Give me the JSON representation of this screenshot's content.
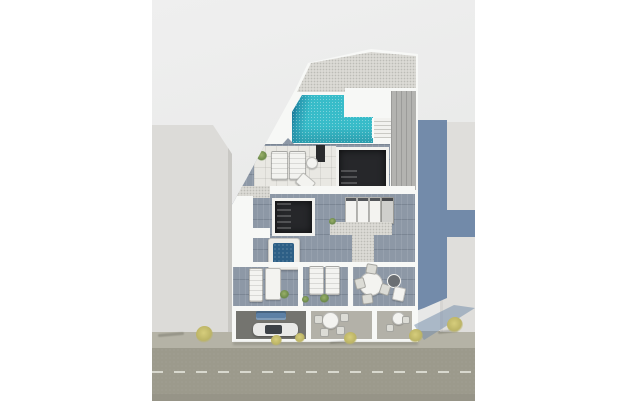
{
  "meta": {
    "description": "Top-down 3D architectural render of a modern apartment building with rooftop pool, wood-deck terraces, hot tub, ground-floor patios and a street with dashed lane markings. No text is visible in the image.",
    "visible_text": []
  },
  "palette": {
    "page_bg": "#ffffff",
    "scene_bg_top": "#efefef",
    "scene_bg": "#e7e8e7",
    "neighbor": "#dcdbd8",
    "neighbor_edge": "#c9c8c4",
    "neighbor_right": "#dfdedb",
    "shadow_blue": "#6e87a7",
    "wall_white": "#f7f8f6",
    "gravel": "#dbdad5",
    "pool_water": "#38bcc9",
    "pool_deep": "#1d7d9c",
    "deck_wood": "#8d98a6",
    "deck_light": "#e9e8e3",
    "side_deck": "#b3b3b0",
    "stair_dark": "#26272a",
    "hot_tub_water": "#2d5f86",
    "sofa_blue": "#5d80a5",
    "pavement_dark": "#74746f",
    "terrace_floor": "#b3b1a8",
    "sidewalk": "#b5b3a6",
    "street": "#9c9a8c",
    "street_edge": "#949285",
    "lane_dash": "#e3e3da",
    "furniture_white": "#f3f3f0",
    "tree_yellow": "#bcb465",
    "plant_green": "#6c8a4a",
    "car_body": "#e9e9e7",
    "glass_dark": "#3c4146"
  },
  "scene": {
    "objects": [
      {
        "name": "rooftop-pool",
        "count": 1
      },
      {
        "name": "hot-tub",
        "count": 1
      },
      {
        "name": "stairwell-opening",
        "count": 2
      },
      {
        "name": "sun-lounger",
        "count": 6
      },
      {
        "name": "round-table",
        "count": 5
      },
      {
        "name": "chair",
        "count": 8
      },
      {
        "name": "ac-unit",
        "count": 4
      },
      {
        "name": "outdoor-sofa",
        "count": 1
      },
      {
        "name": "parked-car",
        "count": 1
      },
      {
        "name": "potted-plant",
        "count": 6
      },
      {
        "name": "street-tree",
        "count": 6
      },
      {
        "name": "neighbor-building",
        "count": 2
      }
    ],
    "street": {
      "lane_marking": "dashed-center-line"
    }
  }
}
